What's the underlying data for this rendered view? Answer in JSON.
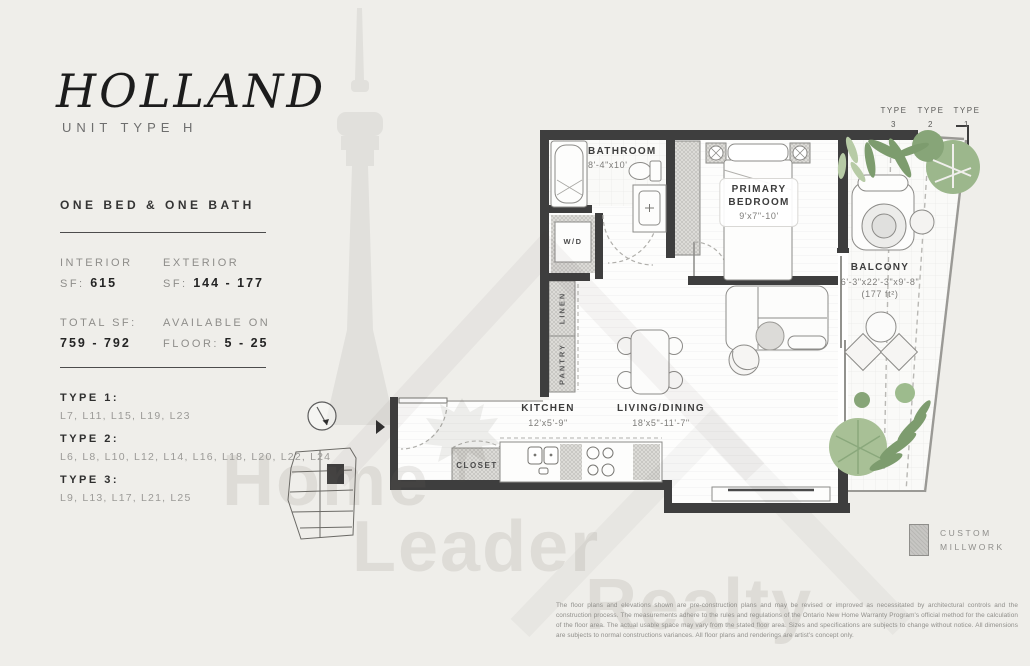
{
  "accent_colors": {
    "wall": "#3e3e3e",
    "paper": "#efeeea",
    "plant_green": "#8fae7f",
    "millwork_gray": "#c7c6c3"
  },
  "header": {
    "title": "HOLLAND",
    "subtitle": "UNIT TYPE H",
    "summary": "ONE BED & ONE BATH"
  },
  "stats": {
    "interior": {
      "label": "INTERIOR",
      "prefix": "SF:",
      "value": "615"
    },
    "exterior": {
      "label": "EXTERIOR",
      "prefix": "SF:",
      "value": "144 - 177"
    },
    "total": {
      "label": "TOTAL SF:",
      "value": "759 - 792"
    },
    "available": {
      "label": "AVAILABLE ON",
      "prefix": "FLOOR:",
      "value": "5 - 25"
    }
  },
  "types": [
    {
      "label": "TYPE 1:",
      "floors": "L7, L11, L15, L19, L23"
    },
    {
      "label": "TYPE 2:",
      "floors": "L6, L8, L10, L12, L14, L16, L18, L20, L22, L24"
    },
    {
      "label": "TYPE 3:",
      "floors": "L9, L13, L17, L21, L25"
    }
  ],
  "type_markers": [
    {
      "word": "TYPE",
      "num": "3"
    },
    {
      "word": "TYPE",
      "num": "2"
    },
    {
      "word": "TYPE",
      "num": "1"
    }
  ],
  "rooms": {
    "bathroom": {
      "name": "BATHROOM",
      "dims": "8'-4\"x10'"
    },
    "bedroom": {
      "line1": "PRIMARY",
      "line2": "BEDROOM",
      "dims": "9'x7\"-10'"
    },
    "balcony": {
      "name": "BALCONY",
      "dims": "6'-3\"x22'-3\"x9'-8\"",
      "area": "(177 ft²)"
    },
    "kitchen": {
      "name": "KITCHEN",
      "dims": "12'x5'-9\""
    },
    "living": {
      "name": "LIVING/DINING",
      "dims": "18'x5\"-11'-7\""
    },
    "closet": "CLOSET",
    "washer_dryer": "W/D",
    "linen": "LINEN",
    "pantry": "PANTRY"
  },
  "legend": {
    "line1": "CUSTOM",
    "line2": "MILLWORK"
  },
  "watermark": {
    "word1": "Home",
    "word2": "Leader",
    "word3": "Realty"
  },
  "disclaimer": "The floor plans and elevations shown are pre-construction plans and may be revised or improved as necessitated by architectural controls and the construction process. The measurements adhere to the rules and regulations of the Ontario New Home Warranty Program's official method for the calculation of the floor area.  The actual usable space may vary from the stated floor area. Sizes and specifications are subjects to change without notice. All dimensions are subjects to normal constructions variances. All floor plans and renderings are artist's concept only."
}
